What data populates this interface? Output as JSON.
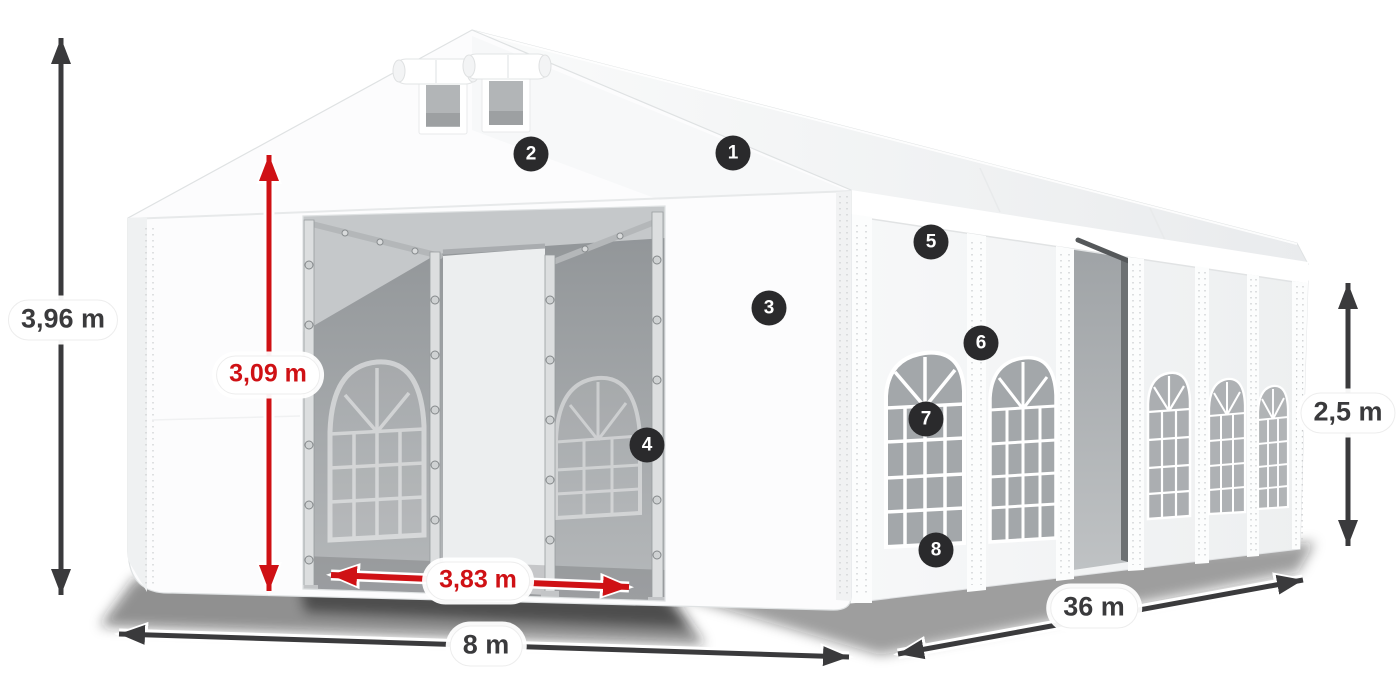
{
  "dimensions": {
    "total_height": "3,96 m",
    "entrance_height": "3,09 m",
    "entrance_width": "3,83 m",
    "width": "8 m",
    "length": "36 m",
    "side_height": "2,5 m"
  },
  "callouts": [
    {
      "number": "1"
    },
    {
      "number": "2"
    },
    {
      "number": "3"
    },
    {
      "number": "4"
    },
    {
      "number": "5"
    },
    {
      "number": "6"
    },
    {
      "number": "7"
    },
    {
      "number": "8"
    }
  ],
  "colors": {
    "dimension_arrow": "#3a3a3c",
    "accent_red": "#cf1115",
    "badge_background": "#2a2a2c",
    "tent_fabric": "#ffffff",
    "interior_gray": "#a7abae"
  }
}
